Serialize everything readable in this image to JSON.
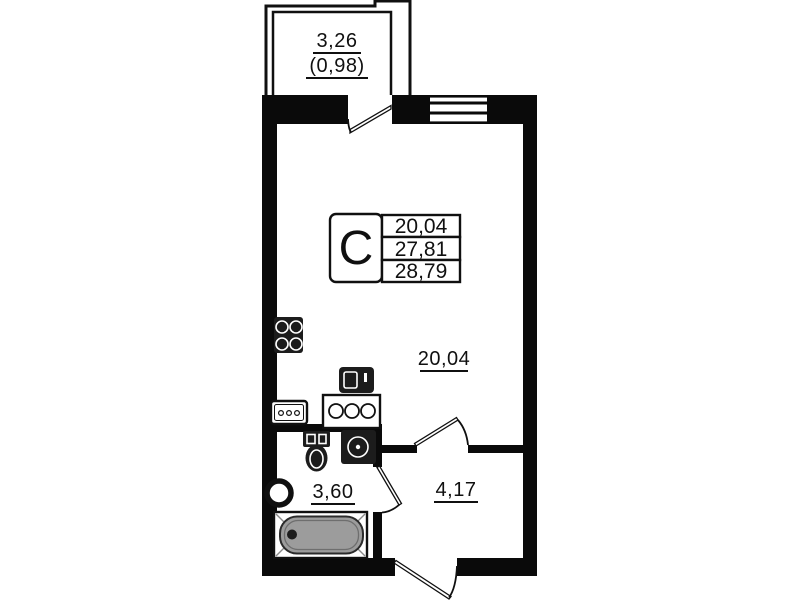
{
  "colors": {
    "wall": "#0a0a0a",
    "fixture": "#1c1c1c",
    "tub_fill": "#9c9c9c",
    "background": "#ffffff"
  },
  "balcony": {
    "area": "3,26",
    "area_reduced": "(0,98)"
  },
  "unit_card": {
    "type": "С",
    "areas": [
      "20,04",
      "27,81",
      "28,79"
    ]
  },
  "rooms": {
    "living": "20,04",
    "bathroom": "3,60",
    "hallway": "4,17"
  },
  "fixtures": {
    "stove": "stove-4-burner-icon",
    "kitchen_sink": "kitchen-sink-icon",
    "washing_machine": "washing-machine-icon",
    "cooktop_counter": "cooktop-3-burner-icon",
    "toilet": "toilet-icon",
    "bathroom_sink": "bathroom-sink-icon",
    "washbasin": "washbasin-icon",
    "bathtub": "bathtub-icon"
  }
}
